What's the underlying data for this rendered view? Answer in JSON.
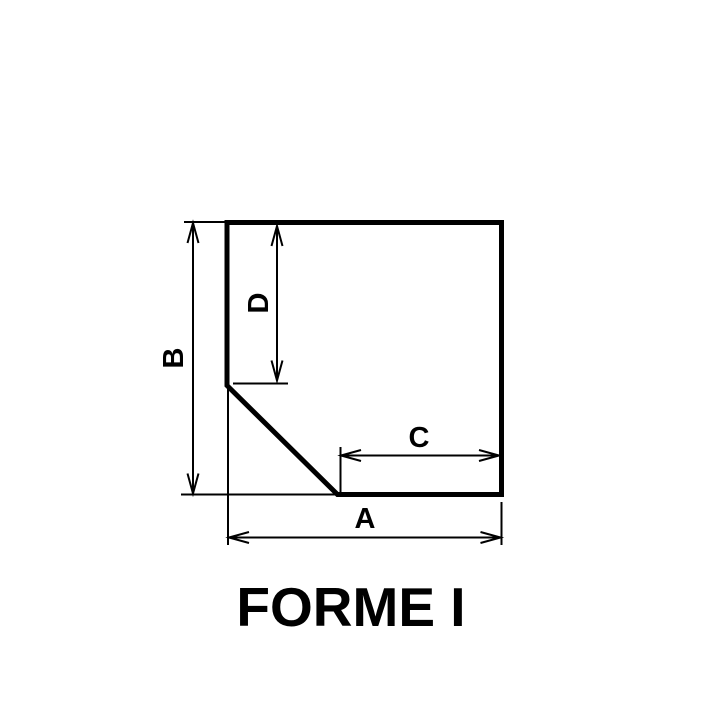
{
  "title": "FORME I",
  "dimension_labels": {
    "a": "A",
    "b": "B",
    "c": "C",
    "d": "D"
  },
  "colors": {
    "line": "#000000",
    "background": "#ffffff"
  }
}
